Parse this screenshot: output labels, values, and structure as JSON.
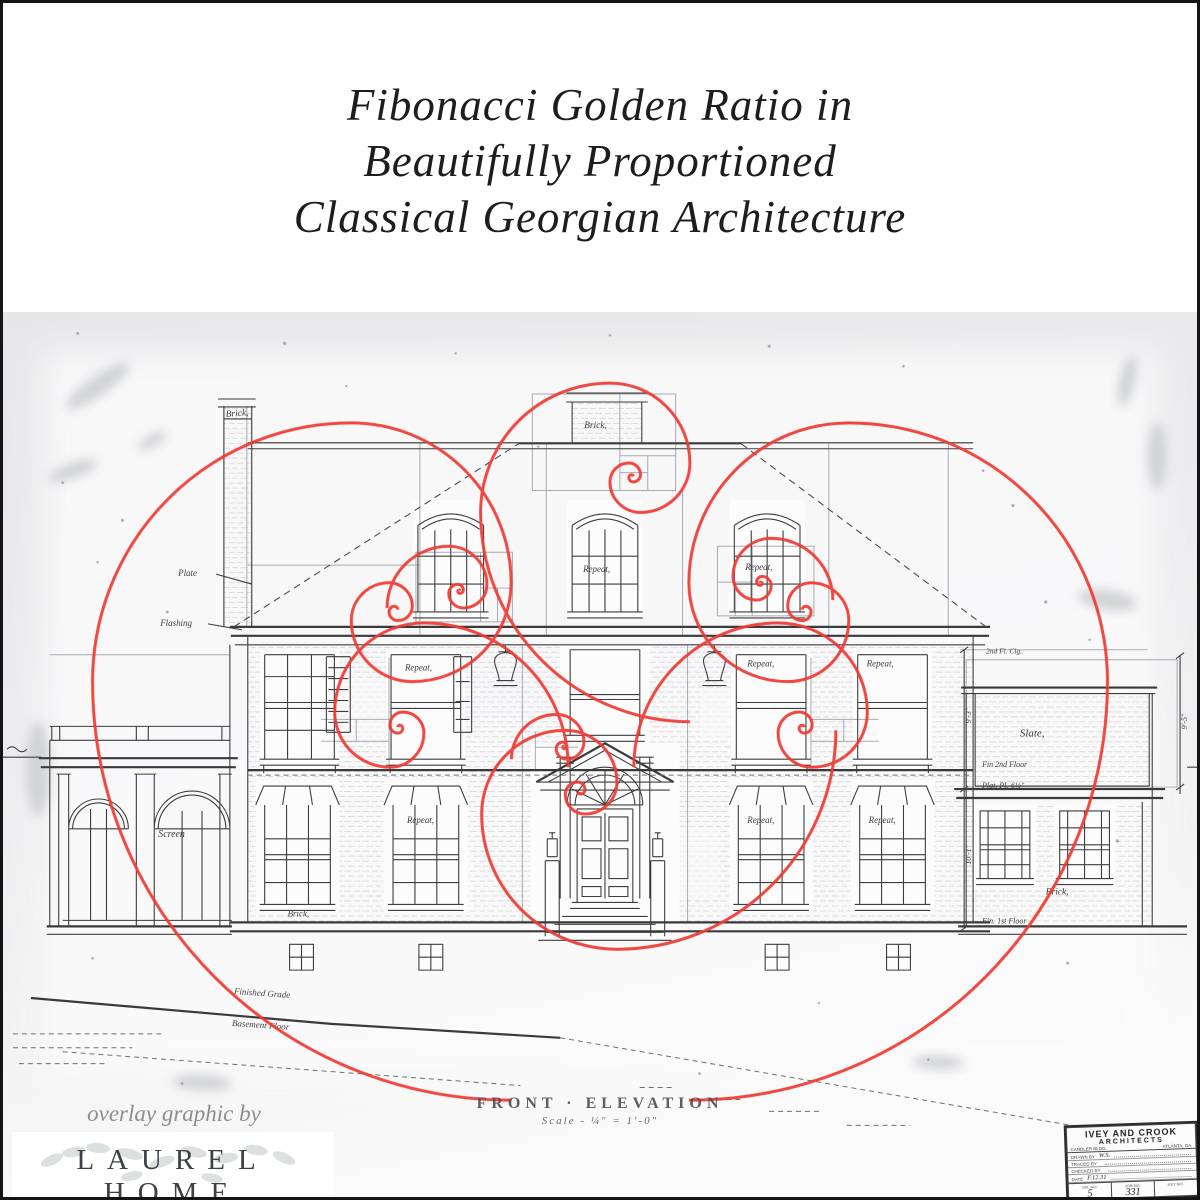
{
  "title": {
    "line1": "Fibonacci Golden Ratio in",
    "line2": "Beautifully Proportioned",
    "line3": "Classical Georgian Architecture"
  },
  "drawing": {
    "caption": "FRONT · ELEVATION",
    "scale_note": "Scale - ¼\" = 1'-0\"",
    "labels": {
      "brick": "Brick,",
      "repeat": "Repeat,",
      "plate": "Plate",
      "flashing": "Flashing",
      "screen": "Screen",
      "slate": "Slate,",
      "clg2": "2nd Fl. Clg.",
      "fin2": "Fin 2nd Floor",
      "platpl": "Plat. Pl.-6½\"",
      "fin1": "Fin. 1st Floor",
      "grade": "Finished Grade",
      "basement": "Basement Floor",
      "dim1": "9'-3\"",
      "dim2": "10'-1\"",
      "dim3": "9'-5\""
    }
  },
  "title_block": {
    "firm1": "IVEY AND CROOK",
    "firm2": "ARCHITECTS",
    "addr_left": "CANDLER BLDG.",
    "addr_right": "ATLANTA, GA.",
    "rows": [
      {
        "label": "DRAWN BY",
        "value": "W.S."
      },
      {
        "label": "TRACED BY",
        "value": ""
      },
      {
        "label": "CHECKED BY",
        "value": ""
      },
      {
        "label": "DATE",
        "value": "F.12.31"
      }
    ],
    "cells": [
      {
        "label": "DR. NO.",
        "value": "5"
      },
      {
        "label": "JOB NO.",
        "value": "331"
      },
      {
        "label": "KEY NO.",
        "value": ""
      }
    ]
  },
  "credit": {
    "prefix": "overlay graphic by",
    "brand": "LAUREL HOME",
    "tagline": "INTERIOR DESIGN | INSPIRATION | STYLE"
  },
  "colors": {
    "spiral_red": "#ef3a33",
    "grid_grey": "#979ea6",
    "ink": "#343434",
    "photo_background": "#ebebed"
  }
}
